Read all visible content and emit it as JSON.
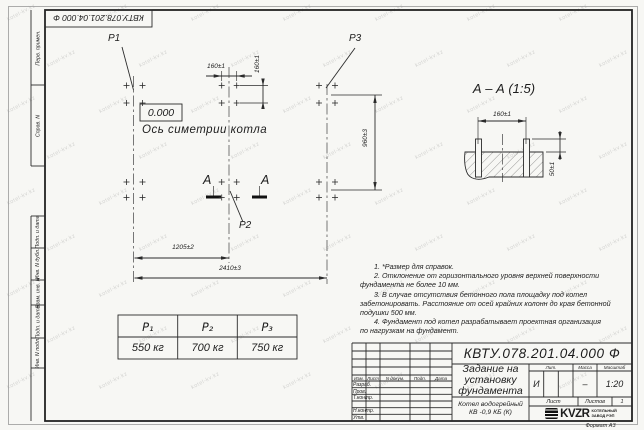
{
  "watermark": {
    "text": "kotel-kv.kz"
  },
  "frame": {
    "stamp_top": "КВТУ.078.201.04.000 Ф",
    "side_labels_top": [
      "Перв. примен.",
      "Справ. N"
    ],
    "side_labels_bottom": [
      "Подп. и дата",
      "Инв. N дубл.",
      "Взам. инв. N",
      "Подп. и дата",
      "Инв. N подл."
    ],
    "format_label": "Формат А3"
  },
  "plan": {
    "level_mark": "0.000",
    "axis_label": "Ось симетрии котла",
    "labels": {
      "p1": "P1",
      "p2": "P2",
      "p3": "P3"
    },
    "section_letter_left": "А",
    "section_letter_right": "А",
    "dims": {
      "w160h": "160±1",
      "w160v": "160±1",
      "h960": "960±3",
      "w1205": "1205±2",
      "w2410": "2410±3"
    },
    "bolts": {
      "cols": [
        126.5,
        142.5,
        221.7,
        236.7,
        319,
        335
      ],
      "rows": [
        85.5,
        103,
        182,
        197.5
      ]
    }
  },
  "section": {
    "title": "А – А (1:5)",
    "dim_width": "160±1",
    "dim_height": "50±1"
  },
  "load_table": {
    "headers": [
      "P₁",
      "P₂",
      "P₃"
    ],
    "values": [
      "550 кг",
      "700 кг",
      "750 кг"
    ]
  },
  "notes": {
    "lines": [
      "1. *Размер для справок.",
      "2. Отклонение от горизонтального уровня верхней поверхности",
      "фундамента не более 10 мм.",
      "3. В случае отсутствия бетонного пола площадку под котел",
      "забетонировать. Расстояние от осей крайних колонн до края бетонной",
      "подушки 500 мм.",
      "4. Фундамент под котел разрабатывает проектная организация",
      "по нагрузкам на фундамент."
    ]
  },
  "title_block": {
    "doc_number": "КВТУ.078.201.04.000 Ф",
    "title_lines": [
      "Задание на",
      "установку",
      "фундамента"
    ],
    "product_lines": [
      "Котел водогрейный",
      "КВ -0,9 КБ (К)"
    ],
    "headers": {
      "lit": "Лит.",
      "mass": "Масса",
      "scale": "Масштаб",
      "sheet": "Лист",
      "sheets": "Листов",
      "sheets_value": "1"
    },
    "values": {
      "lit": "И",
      "mass": "–",
      "scale": "1:20"
    },
    "sig_header": [
      "Изм.",
      "Лист",
      "N докум.",
      "Подп.",
      "Дата"
    ],
    "sig_rows": [
      "Разраб.",
      "Пров.",
      "Т.контр.",
      "Н.контр.",
      "Утв."
    ],
    "company": {
      "name": "KVZR",
      "desc_lines": [
        "КОТЕЛЬНЫЙ",
        "ЗАВОД РЭП"
      ]
    }
  }
}
